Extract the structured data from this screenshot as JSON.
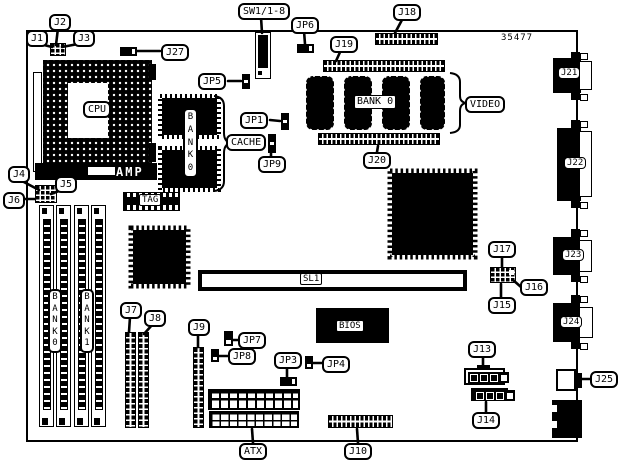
{
  "figure": {
    "type": "motherboard-layout-diagram",
    "part_number": "35477",
    "colors": {
      "ink": "#000000",
      "paper": "#ffffff"
    }
  },
  "labels": {
    "j1": "J1",
    "j2": "J2",
    "j3": "J3",
    "j4": "J4",
    "j5": "J5",
    "j6": "J6",
    "j7": "J7",
    "j8": "J8",
    "j9": "J9",
    "j10": "J10",
    "j13": "J13",
    "j14": "J14",
    "j15": "J15",
    "j16": "J16",
    "j17": "J17",
    "j18": "J18",
    "j19": "J19",
    "j20": "J20",
    "j21": "J21",
    "j22": "J22",
    "j23": "J23",
    "j24": "J24",
    "j25": "J25",
    "j27": "J27",
    "jp1": "JP1",
    "jp3": "JP3",
    "jp4": "JP4",
    "jp5": "JP5",
    "jp6": "JP6",
    "jp7": "JP7",
    "jp8": "JP8",
    "jp9": "JP9",
    "sw1": "SW1/1-8",
    "cpu": "CPU",
    "amp": "AMP",
    "cache": "CACHE",
    "video": "VIDEO",
    "tag": "TAG",
    "bios": "BIOS",
    "sl1": "SL1",
    "atx": "ATX",
    "bank0_video": "BANK 0",
    "bank0_cache": "B\nA\nN\nK\n0",
    "bank0_simm": "B\nA\nN\nK\n0",
    "bank1_simm": "B\nA\nN\nK\n1",
    "part_number": "35477"
  }
}
